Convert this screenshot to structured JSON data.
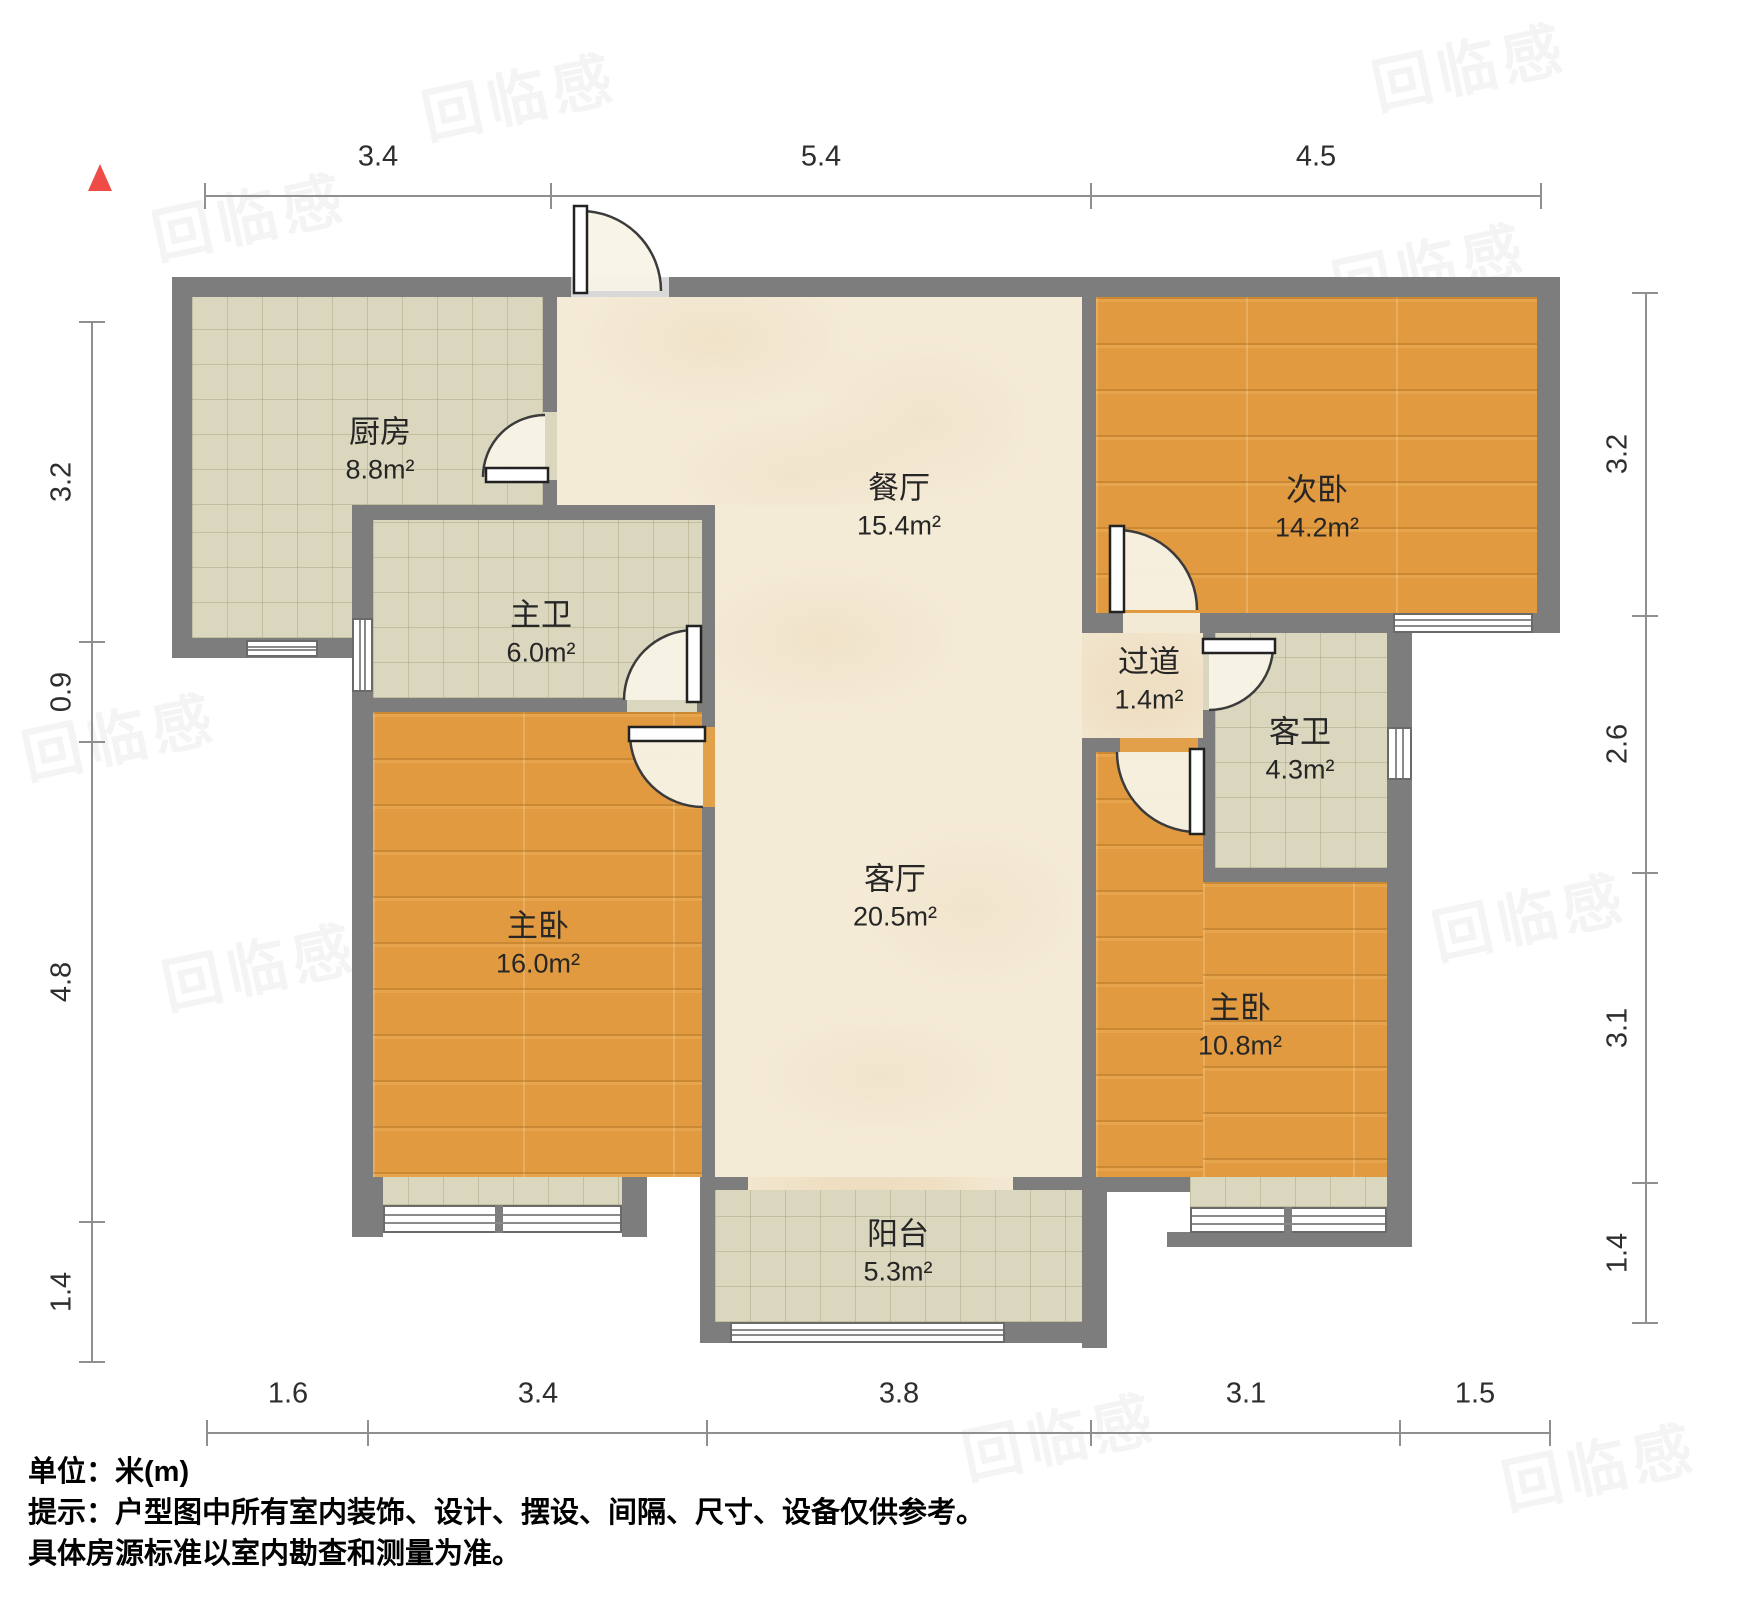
{
  "compass": {
    "icon": "north-arrow",
    "color": "#ef4b47"
  },
  "watermark": {
    "text": "回临感"
  },
  "colors": {
    "wall": "#7d7d7d",
    "tile_floor": "#dad7be",
    "marble_floor": "#f4ebd7",
    "wood_floor": "#e19a3f",
    "north_arrow": "#ef4b47"
  },
  "rooms": [
    {
      "id": "kitchen",
      "name": "厨房",
      "area": "8.8m²"
    },
    {
      "id": "dining",
      "name": "餐厅",
      "area": "15.4m²"
    },
    {
      "id": "bedroom-second",
      "name": "次卧",
      "area": "14.2m²"
    },
    {
      "id": "bath-master",
      "name": "主卫",
      "area": "6.0m²"
    },
    {
      "id": "hallway",
      "name": "过道",
      "area": "1.4m²"
    },
    {
      "id": "bath-guest",
      "name": "客卫",
      "area": "4.3m²"
    },
    {
      "id": "bedroom-master-left",
      "name": "主卧",
      "area": "16.0m²"
    },
    {
      "id": "living",
      "name": "客厅",
      "area": "20.5m²"
    },
    {
      "id": "bedroom-master-right",
      "name": "主卧",
      "area": "10.8m²"
    },
    {
      "id": "balcony",
      "name": "阳台",
      "area": "5.3m²"
    }
  ],
  "dimensions": {
    "top": [
      "3.4",
      "5.4",
      "4.5"
    ],
    "bottom": [
      "1.6",
      "3.4",
      "3.8",
      "3.1",
      "1.5"
    ],
    "left": [
      "3.2",
      "0.9",
      "4.8",
      "1.4"
    ],
    "right": [
      "3.2",
      "2.6",
      "3.1",
      "1.4"
    ]
  },
  "notes": {
    "unit": "单位：米(m)",
    "line1": "提示：户型图中所有室内装饰、设计、摆设、间隔、尺寸、设备仅供参考。",
    "line2": "具体房源标准以室内勘查和测量为准。"
  }
}
